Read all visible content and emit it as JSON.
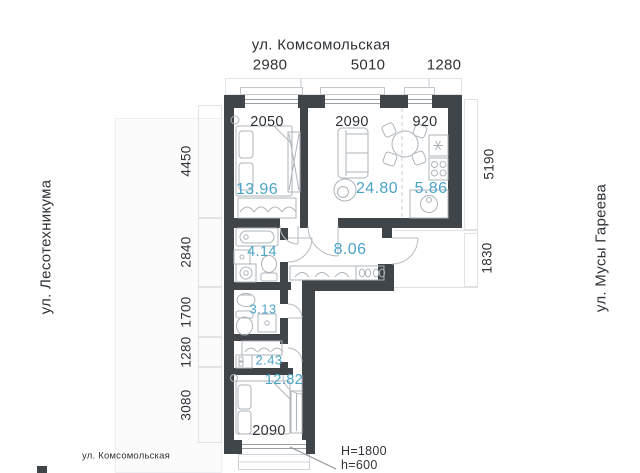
{
  "floor_plan": {
    "streets": {
      "top": "ул. Комсомольская",
      "left": "ул. Лесотехникума",
      "right": "ул. Мусы Гареева",
      "bottom": "ул. Комсомольская"
    },
    "outer_dimensions": {
      "top": [
        "2980",
        "5010",
        "1280"
      ],
      "left": [
        "4450",
        "2840",
        "1700",
        "1280",
        "3080"
      ],
      "right": [
        "5190",
        "1830"
      ]
    },
    "room_dimensions": {
      "bedroom1_width": "2050",
      "living_width": "2090",
      "kitchen_width": "920",
      "bedroom2_width": "2090"
    },
    "rooms": [
      {
        "name": "bedroom-1",
        "area": "13.96"
      },
      {
        "name": "living-room",
        "area": "24.80"
      },
      {
        "name": "kitchen",
        "area": "5.86"
      },
      {
        "name": "bathroom",
        "area": "4.14"
      },
      {
        "name": "hallway",
        "area": "8.06"
      },
      {
        "name": "wc",
        "area": "3.13"
      },
      {
        "name": "wardrobe",
        "area": "2.43"
      },
      {
        "name": "bedroom-2",
        "area": "12.82"
      }
    ],
    "window_note": {
      "height": "H=1800",
      "sill": "h=600"
    },
    "colors": {
      "wall": "#404549",
      "area_label": "#4ba4c8",
      "text": "#2f3337"
    }
  }
}
